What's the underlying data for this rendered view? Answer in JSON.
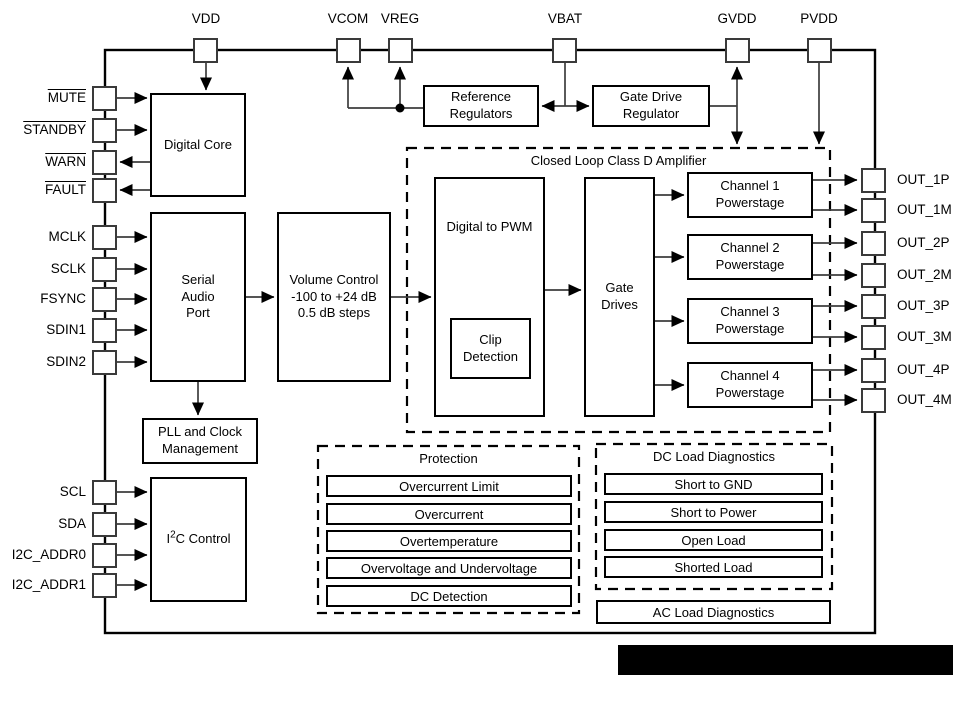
{
  "pins": {
    "top": [
      "VDD",
      "VCOM",
      "VREG",
      "VBAT",
      "GVDD",
      "PVDD"
    ],
    "left": [
      "MUTE",
      "STANDBY",
      "WARN",
      "FAULT",
      "MCLK",
      "SCLK",
      "FSYNC",
      "SDIN1",
      "SDIN2",
      "SCL",
      "SDA",
      "I2C_ADDR0",
      "I2C_ADDR1"
    ],
    "right": [
      "OUT_1P",
      "OUT_1M",
      "OUT_2P",
      "OUT_2M",
      "OUT_3P",
      "OUT_3M",
      "OUT_4P",
      "OUT_4M"
    ]
  },
  "blocks": {
    "digital_core": "Digital Core",
    "serial_audio_port": {
      "line1": "Serial",
      "line2": "Audio",
      "line3": "Port"
    },
    "volume_control": {
      "line1": "Volume Control",
      "line2": "-100 to +24 dB",
      "line3": "0.5 dB steps"
    },
    "pll": {
      "line1": "PLL and Clock",
      "line2": "Management"
    },
    "i2c_control": {
      "pre": "I",
      "sup": "2",
      "post": "C Control"
    },
    "reference_regulators": {
      "line1": "Reference",
      "line2": "Regulators"
    },
    "gate_drive_regulator": {
      "line1": "Gate Drive",
      "line2": "Regulator"
    },
    "digital_to_pwm": "Digital to PWM",
    "clip_detection": {
      "line1": "Clip",
      "line2": "Detection"
    },
    "gate_drives": {
      "line1": "Gate",
      "line2": "Drives"
    },
    "channels": [
      {
        "line1": "Channel 1",
        "line2": "Powerstage"
      },
      {
        "line1": "Channel 2",
        "line2": "Powerstage"
      },
      {
        "line1": "Channel 3",
        "line2": "Powerstage"
      },
      {
        "line1": "Channel 4",
        "line2": "Powerstage"
      }
    ]
  },
  "groups": {
    "closed_loop": {
      "title": "Closed Loop Class D Amplifier"
    },
    "protection": {
      "title": "Protection",
      "items": [
        "Overcurrent Limit",
        "Overcurrent",
        "Overtemperature",
        "Overvoltage and Undervoltage",
        "DC Detection"
      ]
    },
    "dc_load": {
      "title": "DC Load Diagnostics",
      "items": [
        "Short to GND",
        "Short to Power",
        "Open Load",
        "Shorted Load"
      ]
    },
    "ac_load": {
      "label": "AC Load Diagnostics"
    }
  },
  "colors": {
    "line": "#000000",
    "connector": "#3d3d3d",
    "background": "#ffffff",
    "redaction_bar": "#000000"
  }
}
